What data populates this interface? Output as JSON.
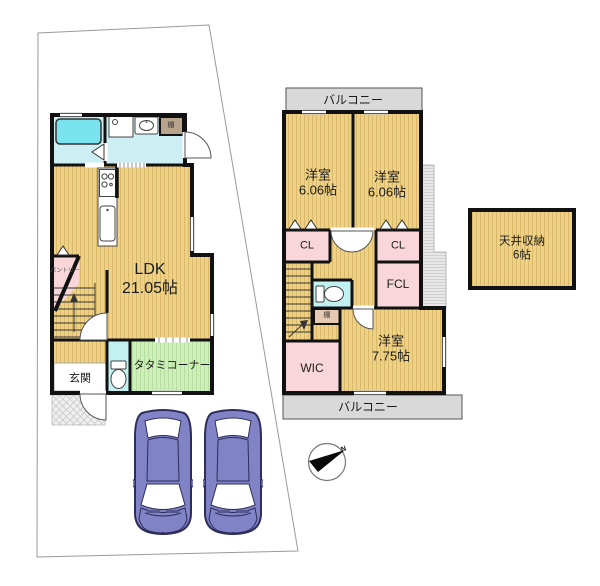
{
  "floor1": {
    "ldk_name": "LDK",
    "ldk_size": "21.05帖",
    "tatami_corner": "タタミコーナー",
    "genkan": "玄関",
    "pantry": "パントリー",
    "shelf": "棚"
  },
  "floor2": {
    "balcony_top": "バルコニー",
    "balcony_bottom": "バルコニー",
    "bedroom_left_name": "洋室",
    "bedroom_left_size": "6.06帖",
    "bedroom_right_name": "洋室",
    "bedroom_right_size": "6.06帖",
    "bedroom_main_name": "洋室",
    "bedroom_main_size": "7.75帖",
    "closet_left": "CL",
    "closet_right": "CL",
    "fcl": "FCL",
    "wic": "WIC",
    "shelf": "棚"
  },
  "attic": {
    "name": "天井収納",
    "size": "6帖"
  },
  "compass": {
    "north": "N"
  },
  "colors": {
    "wall": "#111111",
    "floor_tan": "#ecd189",
    "floor_stripe": "#c49b42",
    "closet_pink": "#f8d6da",
    "wet_area_cyan": "#cdeef2",
    "bathtub_cyan": "#79e3ee",
    "toilet_cyan": "#c2f1f1",
    "tatami_green": "#cfeebb",
    "balcony_gray": "#d9d9d9",
    "car_purple": "#8084c6",
    "shelf_brown": "#b8a48c"
  }
}
